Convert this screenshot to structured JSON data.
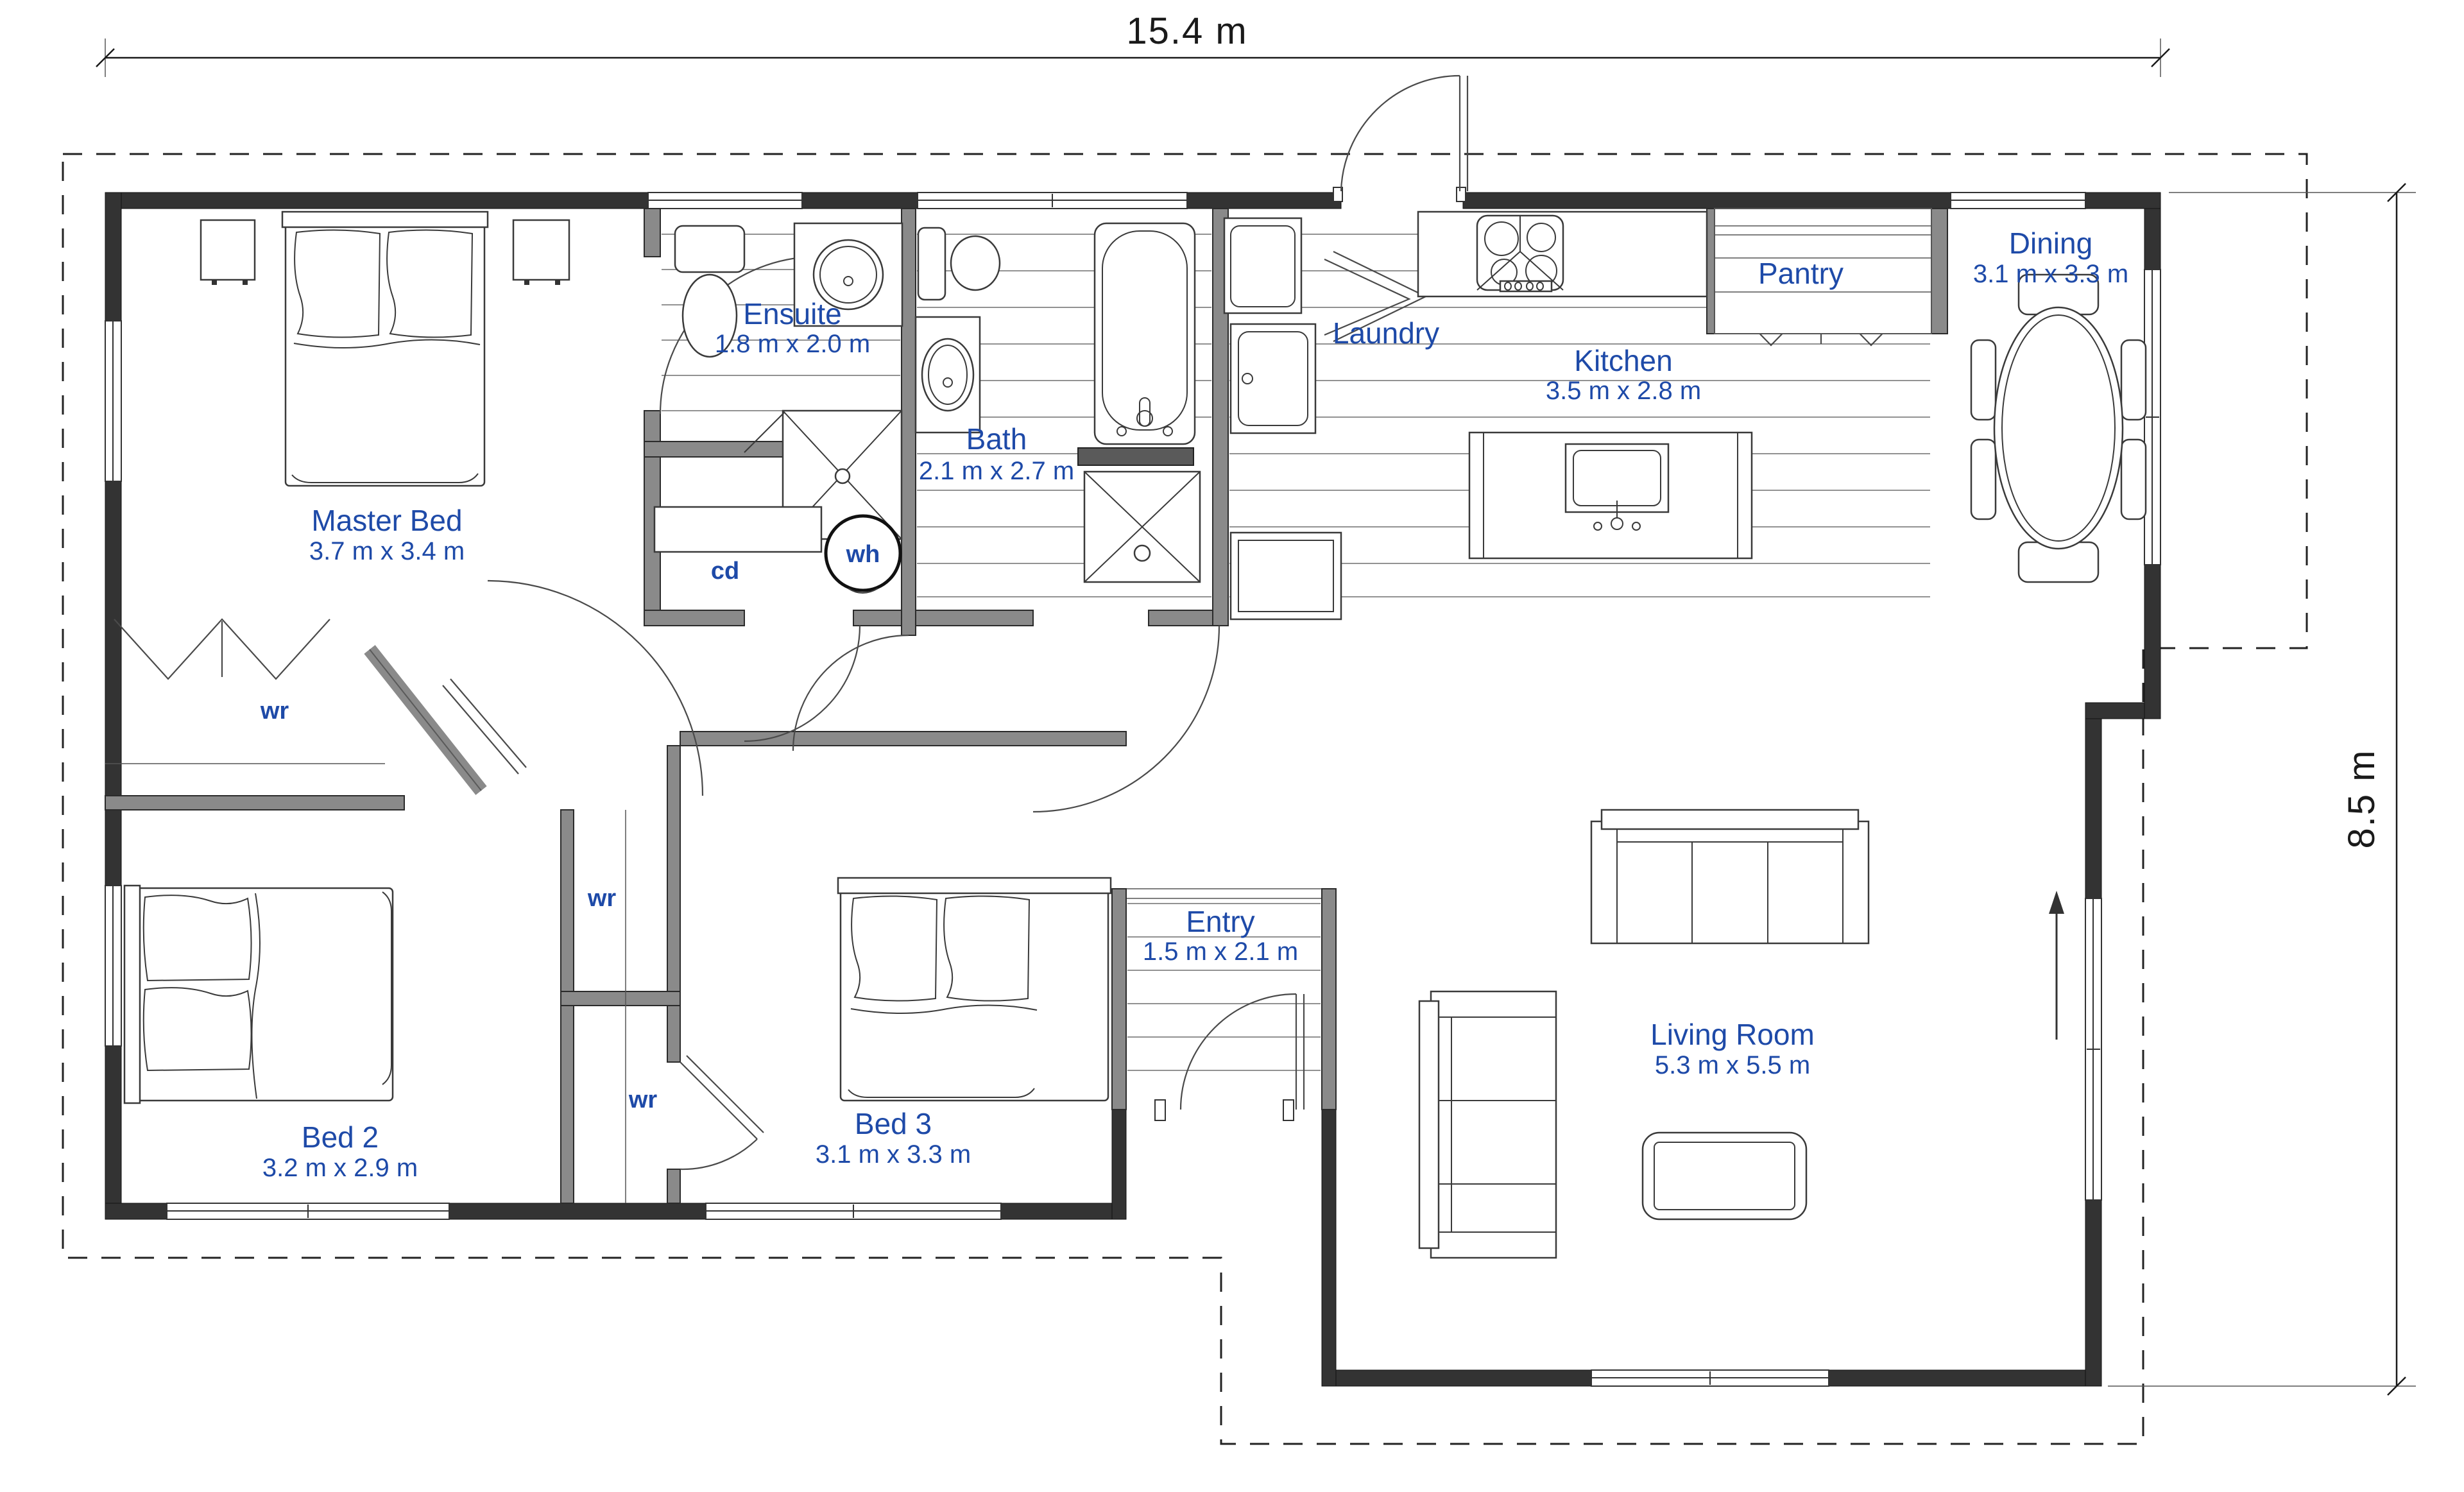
{
  "plan": {
    "overall_dimensions": {
      "width_label": "15.4 m",
      "height_label": "8.5 m"
    },
    "rooms": {
      "master": {
        "label": "Master Bed",
        "dims": "3.7 m x 3.4 m"
      },
      "ensuite": {
        "label": "Ensuite",
        "dims": "1.8 m x 2.0 m"
      },
      "bath": {
        "label": "Bath",
        "dims": "2.1 m x 2.7 m"
      },
      "laundry": {
        "label": "Laundry"
      },
      "kitchen": {
        "label": "Kitchen",
        "dims": "3.5 m x 2.8 m"
      },
      "pantry": {
        "label": "Pantry"
      },
      "dining": {
        "label": "Dining",
        "dims": "3.1 m x 3.3 m"
      },
      "bed2": {
        "label": "Bed 2",
        "dims": "3.2 m x 2.9 m"
      },
      "bed3": {
        "label": "Bed 3",
        "dims": "3.1 m x 3.3 m"
      },
      "entry": {
        "label": "Entry",
        "dims": "1.5 m x 2.1 m"
      },
      "living": {
        "label": "Living Room",
        "dims": "5.3 m x 5.5 m"
      }
    },
    "annotations": {
      "wardrobe": "wr",
      "cupboard": "cd",
      "water_heater": "wh"
    },
    "colors": {
      "label_blue": "#1e4aa8",
      "wall_dark": "#333333",
      "wall_gray": "#8a8a8a"
    }
  }
}
